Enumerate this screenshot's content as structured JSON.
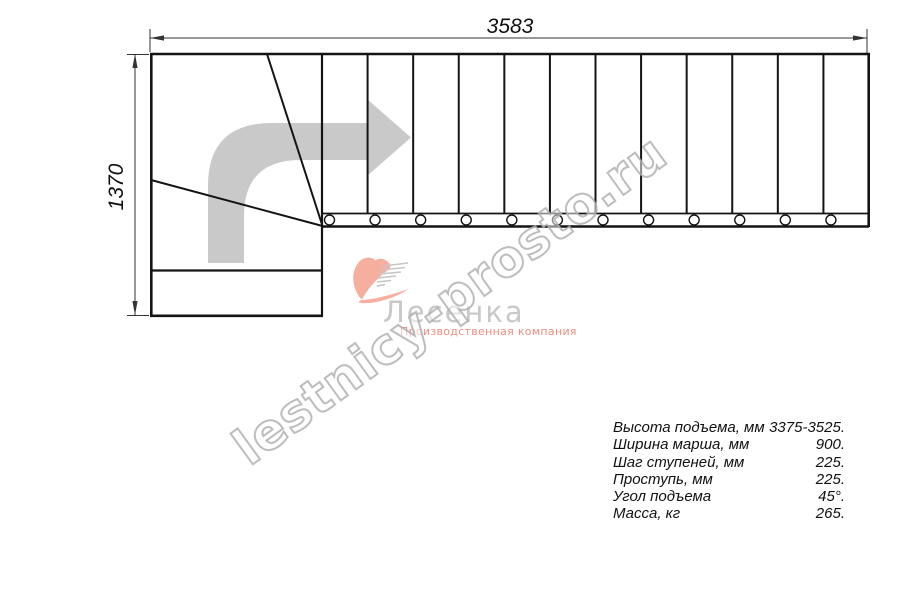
{
  "dimensions": {
    "width_label": "3583",
    "height_label": "1370"
  },
  "stairs": {
    "step_count": 12
  },
  "watermark": {
    "text": "lestnicy-prosto.ru"
  },
  "logo": {
    "name": "Лесенка",
    "tagline": "Производственная компания"
  },
  "specs": {
    "rows": [
      {
        "label": "Высота подъема, мм",
        "value": "3375-3525."
      },
      {
        "label": "Ширина марша, мм",
        "value": "900."
      },
      {
        "label": "Шаг ступеней, мм",
        "value": "225."
      },
      {
        "label": "Проступь, мм",
        "value": "225."
      },
      {
        "label": "Угол подъема",
        "value": "45°."
      },
      {
        "label": "Масса, кг",
        "value": "265."
      }
    ]
  },
  "colors": {
    "line": "#141414",
    "dim_line": "#333333",
    "direction_arrow": "#c9c9c9",
    "logo_accent": "#f5a18d",
    "logo_text": "#c8c8c8",
    "logo_tagline": "#ed8c7d",
    "watermark_outline": "#acacac"
  }
}
